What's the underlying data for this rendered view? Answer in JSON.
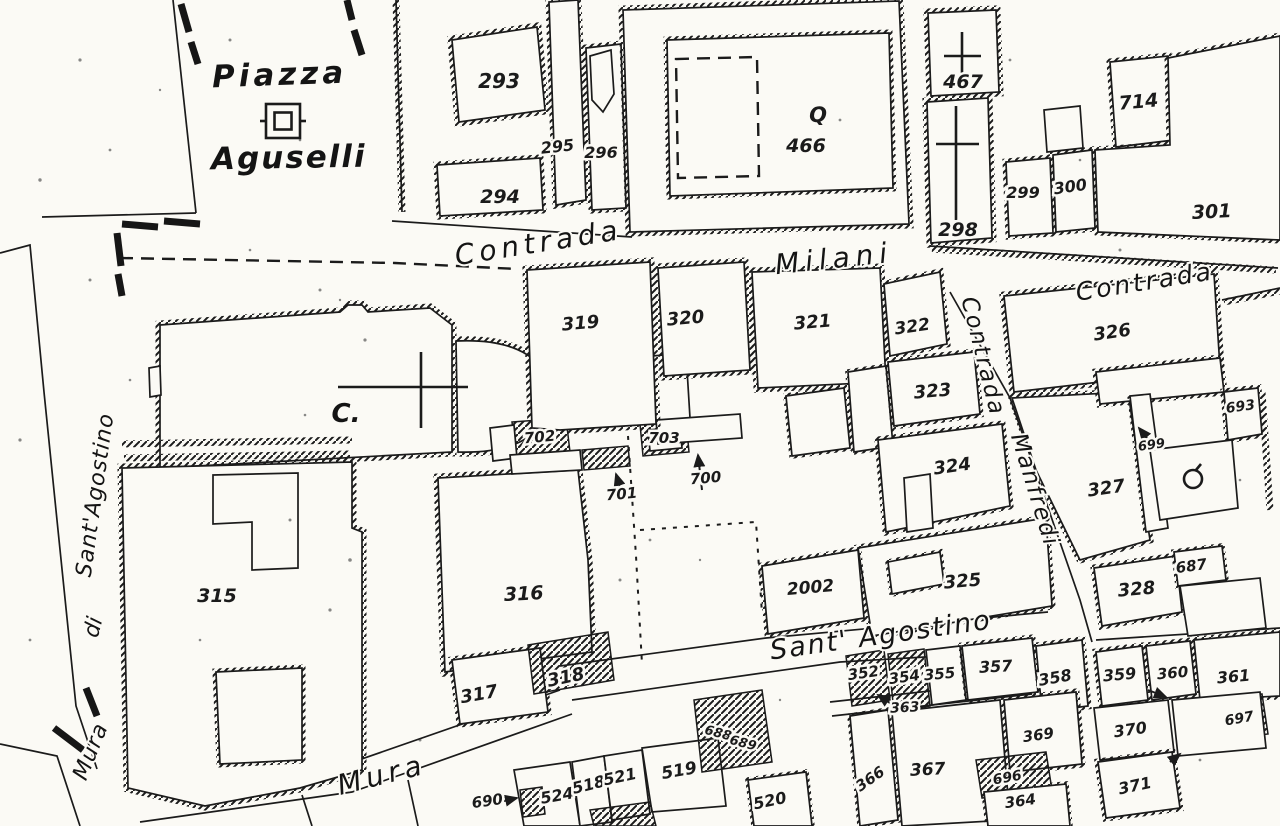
{
  "title": "Historic cadastral map — Piazza Aguselli / Contrada Milani / Sant'Agostino",
  "colors": {
    "paper": "#fbfaf5",
    "ink": "#1b1b1b"
  },
  "place_labels": [
    {
      "id": "piazza",
      "text": "Piazza",
      "x": 280,
      "y": 85,
      "size": 31,
      "rotate": -2,
      "spacing": 4
    },
    {
      "id": "aguselli",
      "text": "Aguselli",
      "x": 289,
      "y": 168,
      "size": 31,
      "rotate": -1,
      "spacing": 2
    },
    {
      "id": "church-initial",
      "text": "C.",
      "x": 346,
      "y": 422,
      "size": 26,
      "rotate": 0,
      "spacing": 0
    }
  ],
  "street_labels": [
    {
      "id": "contrada-top-left",
      "text": "Contrada",
      "x": 540,
      "y": 252,
      "size": 28,
      "rotate": -9,
      "spacing": 5
    },
    {
      "id": "milani",
      "text": "Milani",
      "x": 835,
      "y": 268,
      "size": 28,
      "rotate": -6,
      "spacing": 6
    },
    {
      "id": "contrada-top-right",
      "text": "Contrada",
      "x": 1146,
      "y": 290,
      "size": 25,
      "rotate": -9,
      "spacing": 3
    },
    {
      "id": "contrada-vertical",
      "text": "Contrada",
      "x": 976,
      "y": 358,
      "size": 23,
      "rotate": 76,
      "spacing": 2
    },
    {
      "id": "manfredi",
      "text": "Manfredi",
      "x": 1028,
      "y": 492,
      "size": 23,
      "rotate": 73,
      "spacing": 2
    },
    {
      "id": "sant-agostino-street",
      "text": "Sant' Agostino",
      "x": 882,
      "y": 644,
      "size": 27,
      "rotate": -8,
      "spacing": 2
    },
    {
      "id": "mura-street",
      "text": "Mura",
      "x": 384,
      "y": 784,
      "size": 28,
      "rotate": -14,
      "spacing": 5
    },
    {
      "id": "mura-di-santagostino-1",
      "text": "Sant'Agostino",
      "x": 102,
      "y": 496,
      "size": 22,
      "rotate": -82,
      "spacing": 1
    },
    {
      "id": "mura-di-santagostino-2",
      "text": "di",
      "x": 100,
      "y": 629,
      "size": 22,
      "rotate": -75,
      "spacing": 0
    },
    {
      "id": "mura-di-santagostino-3",
      "text": "Mura",
      "x": 97,
      "y": 754,
      "size": 22,
      "rotate": -68,
      "spacing": 1
    }
  ],
  "parcel_labels": [
    {
      "id": "293",
      "text": "293",
      "x": 499,
      "y": 88,
      "size": 20,
      "rotate": 0
    },
    {
      "id": "295",
      "text": "295",
      "x": 558,
      "y": 152,
      "size": 16,
      "rotate": -6
    },
    {
      "id": "296",
      "text": "296",
      "x": 601,
      "y": 158,
      "size": 16,
      "rotate": 0
    },
    {
      "id": "294",
      "text": "294",
      "x": 500,
      "y": 203,
      "size": 19,
      "rotate": 0
    },
    {
      "id": "466",
      "text": "466",
      "x": 806,
      "y": 152,
      "size": 19,
      "rotate": 0
    },
    {
      "id": "467",
      "text": "467",
      "x": 963,
      "y": 88,
      "size": 19,
      "rotate": 0
    },
    {
      "id": "298",
      "text": "298",
      "x": 958,
      "y": 236,
      "size": 19,
      "rotate": 0
    },
    {
      "id": "299",
      "text": "299",
      "x": 1023,
      "y": 198,
      "size": 16,
      "rotate": 0
    },
    {
      "id": "300",
      "text": "300",
      "x": 1071,
      "y": 192,
      "size": 16,
      "rotate": -8
    },
    {
      "id": "714",
      "text": "714",
      "x": 1139,
      "y": 108,
      "size": 19,
      "rotate": -5
    },
    {
      "id": "301",
      "text": "301",
      "x": 1212,
      "y": 218,
      "size": 19,
      "rotate": -3
    },
    {
      "id": "319",
      "text": "319",
      "x": 581,
      "y": 329,
      "size": 18,
      "rotate": -5
    },
    {
      "id": "320",
      "text": "320",
      "x": 686,
      "y": 324,
      "size": 18,
      "rotate": -5
    },
    {
      "id": "321",
      "text": "321",
      "x": 813,
      "y": 328,
      "size": 18,
      "rotate": -5
    },
    {
      "id": "322",
      "text": "322",
      "x": 913,
      "y": 332,
      "size": 17,
      "rotate": -8
    },
    {
      "id": "323",
      "text": "323",
      "x": 933,
      "y": 397,
      "size": 18,
      "rotate": -5
    },
    {
      "id": "324",
      "text": "324",
      "x": 953,
      "y": 472,
      "size": 18,
      "rotate": -8
    },
    {
      "id": "325",
      "text": "325",
      "x": 963,
      "y": 587,
      "size": 18,
      "rotate": -5
    },
    {
      "id": "326",
      "text": "326",
      "x": 1113,
      "y": 338,
      "size": 18,
      "rotate": -8
    },
    {
      "id": "327",
      "text": "327",
      "x": 1107,
      "y": 494,
      "size": 18,
      "rotate": -8
    },
    {
      "id": "328",
      "text": "328",
      "x": 1137,
      "y": 595,
      "size": 18,
      "rotate": -5
    },
    {
      "id": "315",
      "text": "315",
      "x": 217,
      "y": 602,
      "size": 19,
      "rotate": 0
    },
    {
      "id": "316",
      "text": "316",
      "x": 524,
      "y": 600,
      "size": 19,
      "rotate": -3
    },
    {
      "id": "317",
      "text": "317",
      "x": 480,
      "y": 700,
      "size": 18,
      "rotate": -10
    },
    {
      "id": "318",
      "text": "318",
      "x": 567,
      "y": 683,
      "size": 18,
      "rotate": -12
    },
    {
      "id": "2002",
      "text": "2002",
      "x": 811,
      "y": 593,
      "size": 17,
      "rotate": -5
    },
    {
      "id": "702",
      "text": "702",
      "x": 540,
      "y": 442,
      "size": 15,
      "rotate": -5
    },
    {
      "id": "703",
      "text": "703",
      "x": 664,
      "y": 443,
      "size": 15,
      "rotate": 0
    },
    {
      "id": "701",
      "text": "701",
      "x": 622,
      "y": 499,
      "size": 15,
      "rotate": -5
    },
    {
      "id": "700",
      "text": "700",
      "x": 706,
      "y": 483,
      "size": 15,
      "rotate": -5
    },
    {
      "id": "699",
      "text": "699",
      "x": 1152,
      "y": 449,
      "size": 13,
      "rotate": -8
    },
    {
      "id": "693",
      "text": "693",
      "x": 1241,
      "y": 411,
      "size": 14,
      "rotate": -8
    },
    {
      "id": "687",
      "text": "687",
      "x": 1192,
      "y": 571,
      "size": 15,
      "rotate": -8
    },
    {
      "id": "688",
      "text": "688",
      "x": 717,
      "y": 737,
      "size": 13,
      "rotate": 15
    },
    {
      "id": "689",
      "text": "689",
      "x": 742,
      "y": 747,
      "size": 13,
      "rotate": 15
    },
    {
      "id": "690",
      "text": "690",
      "x": 488,
      "y": 806,
      "size": 15,
      "rotate": -8
    },
    {
      "id": "524",
      "text": "524",
      "x": 558,
      "y": 801,
      "size": 16,
      "rotate": -10
    },
    {
      "id": "518",
      "text": "518",
      "x": 590,
      "y": 790,
      "size": 16,
      "rotate": -14
    },
    {
      "id": "521",
      "text": "521",
      "x": 621,
      "y": 782,
      "size": 16,
      "rotate": -12
    },
    {
      "id": "519",
      "text": "519",
      "x": 680,
      "y": 776,
      "size": 17,
      "rotate": -10
    },
    {
      "id": "520",
      "text": "520",
      "x": 771,
      "y": 806,
      "size": 16,
      "rotate": -12
    },
    {
      "id": "352",
      "text": "352",
      "x": 864,
      "y": 678,
      "size": 15,
      "rotate": -8
    },
    {
      "id": "354",
      "text": "354",
      "x": 905,
      "y": 682,
      "size": 15,
      "rotate": -8
    },
    {
      "id": "355",
      "text": "355",
      "x": 940,
      "y": 679,
      "size": 15,
      "rotate": -5
    },
    {
      "id": "357",
      "text": "357",
      "x": 996,
      "y": 672,
      "size": 16,
      "rotate": -3
    },
    {
      "id": "358",
      "text": "358",
      "x": 1056,
      "y": 683,
      "size": 16,
      "rotate": -10
    },
    {
      "id": "363",
      "text": "363",
      "x": 905,
      "y": 712,
      "size": 14,
      "rotate": -3
    },
    {
      "id": "359",
      "text": "359",
      "x": 1120,
      "y": 680,
      "size": 16,
      "rotate": -5
    },
    {
      "id": "360",
      "text": "360",
      "x": 1173,
      "y": 678,
      "size": 15,
      "rotate": -5
    },
    {
      "id": "361",
      "text": "361",
      "x": 1234,
      "y": 682,
      "size": 16,
      "rotate": -5
    },
    {
      "id": "697",
      "text": "697",
      "x": 1240,
      "y": 723,
      "size": 14,
      "rotate": -10
    },
    {
      "id": "370",
      "text": "370",
      "x": 1131,
      "y": 735,
      "size": 16,
      "rotate": -8
    },
    {
      "id": "371",
      "text": "371",
      "x": 1136,
      "y": 791,
      "size": 16,
      "rotate": -12
    },
    {
      "id": "369",
      "text": "369",
      "x": 1039,
      "y": 740,
      "size": 15,
      "rotate": -8
    },
    {
      "id": "366",
      "text": "366",
      "x": 873,
      "y": 783,
      "size": 15,
      "rotate": -35
    },
    {
      "id": "367",
      "text": "367",
      "x": 928,
      "y": 775,
      "size": 17,
      "rotate": -3
    },
    {
      "id": "696",
      "text": "696",
      "x": 1008,
      "y": 782,
      "size": 14,
      "rotate": -10
    },
    {
      "id": "364",
      "text": "364",
      "x": 1021,
      "y": 806,
      "size": 15,
      "rotate": -8
    }
  ],
  "symbols": [
    {
      "id": "piazza-marker",
      "type": "double-square",
      "x": 283,
      "y": 121,
      "size": 34
    },
    {
      "id": "q-building-mark",
      "type": "char",
      "char": "Q",
      "x": 818,
      "y": 122,
      "size": 21
    },
    {
      "id": "cross-467",
      "type": "cross",
      "cx": 962,
      "y1": 32,
      "y2": 78,
      "x1": 944,
      "x2": 981,
      "yh": 56
    },
    {
      "id": "cross-298",
      "type": "cross",
      "cx": 956,
      "y1": 106,
      "y2": 220,
      "x1": 936,
      "x2": 979,
      "yh": 144
    },
    {
      "id": "church-cross",
      "type": "cross",
      "cx": 421,
      "y1": 352,
      "y2": 428,
      "x1": 338,
      "x2": 468,
      "yh": 387
    },
    {
      "id": "well-marker",
      "type": "well",
      "x": 1193,
      "y": 479,
      "r": 9
    }
  ]
}
